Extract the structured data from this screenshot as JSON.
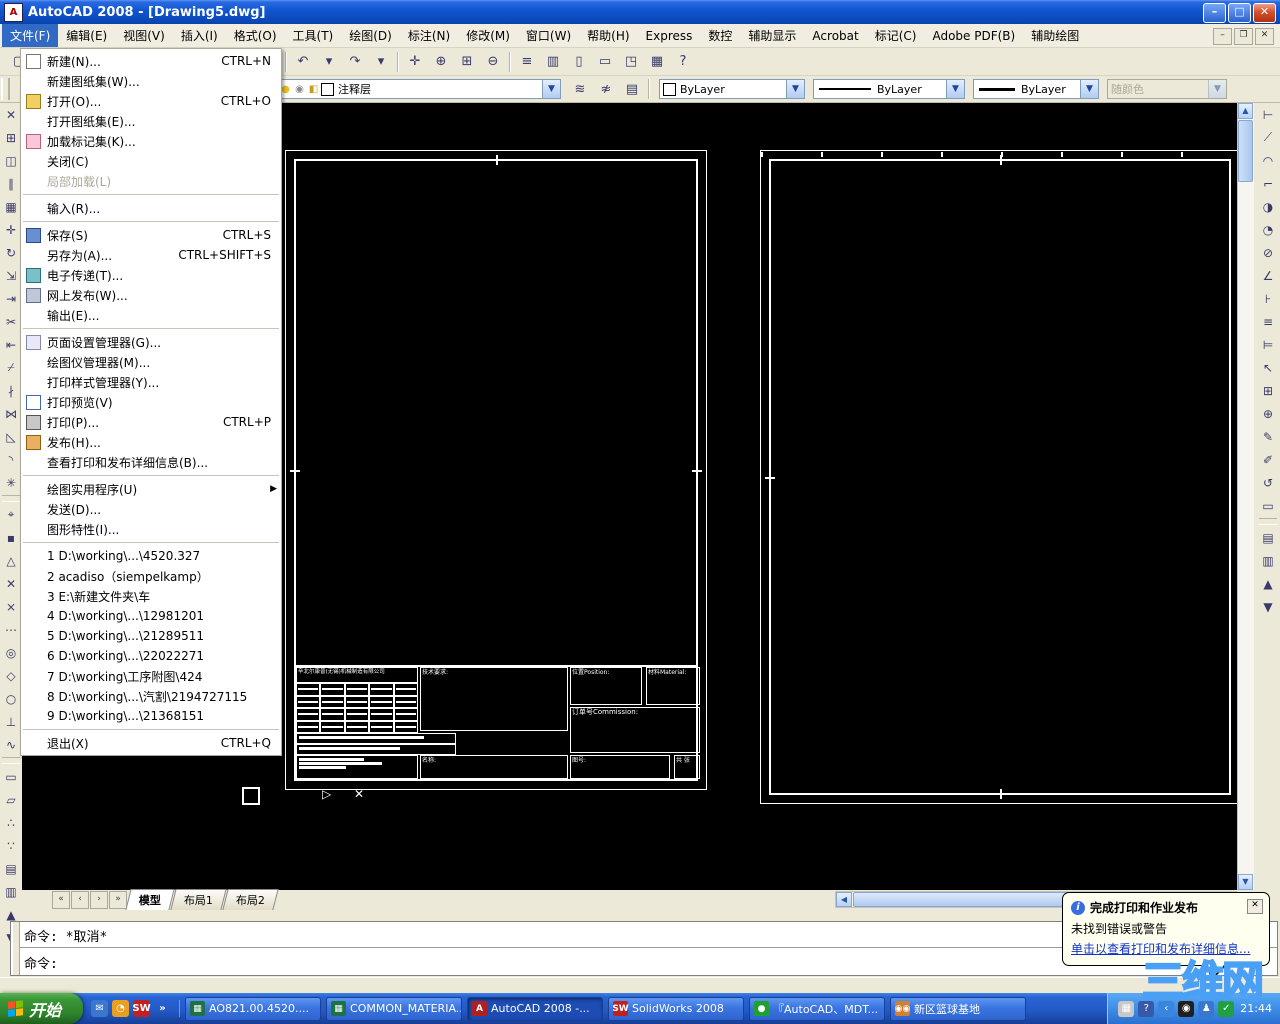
{
  "titlebar": {
    "title": "AutoCAD 2008 - [Drawing5.dwg]",
    "buttons": {
      "minimize": "–",
      "maximize": "□",
      "close": "✕"
    }
  },
  "menubar": {
    "items": [
      {
        "name": "file",
        "label": "文件(F)",
        "active": true
      },
      {
        "name": "edit",
        "label": "编辑(E)"
      },
      {
        "name": "view",
        "label": "视图(V)"
      },
      {
        "name": "insert",
        "label": "插入(I)"
      },
      {
        "name": "format",
        "label": "格式(O)"
      },
      {
        "name": "tools",
        "label": "工具(T)"
      },
      {
        "name": "draw",
        "label": "绘图(D)"
      },
      {
        "name": "dimension",
        "label": "标注(N)"
      },
      {
        "name": "modify",
        "label": "修改(M)"
      },
      {
        "name": "window",
        "label": "窗口(W)"
      },
      {
        "name": "help",
        "label": "帮助(H)"
      },
      {
        "name": "express",
        "label": "Express"
      },
      {
        "name": "cnc",
        "label": "数控"
      },
      {
        "name": "aux-display",
        "label": "辅助显示"
      },
      {
        "name": "acrobat",
        "label": "Acrobat"
      },
      {
        "name": "markup",
        "label": "标记(C)"
      },
      {
        "name": "adobe-pdf",
        "label": "Adobe PDF(B)"
      },
      {
        "name": "aux-draw",
        "label": "辅助绘图"
      }
    ]
  },
  "file_menu": {
    "items": [
      {
        "type": "item",
        "name": "new",
        "icon": "new",
        "label": "新建(N)...",
        "shortcut": "CTRL+N"
      },
      {
        "type": "item",
        "name": "new-sheet-set",
        "label": "新建图纸集(W)..."
      },
      {
        "type": "item",
        "name": "open",
        "icon": "open",
        "label": "打开(O)...",
        "shortcut": "CTRL+O"
      },
      {
        "type": "item",
        "name": "open-sheet-set",
        "label": "打开图纸集(E)..."
      },
      {
        "type": "item",
        "name": "load-markup-set",
        "icon": "markup",
        "label": "加载标记集(K)..."
      },
      {
        "type": "item",
        "name": "close",
        "label": "关闭(C)"
      },
      {
        "type": "item",
        "name": "partial-load",
        "label": "局部加载(L)",
        "disabled": true
      },
      {
        "type": "sep"
      },
      {
        "type": "item",
        "name": "import",
        "label": "输入(R)..."
      },
      {
        "type": "sep"
      },
      {
        "type": "item",
        "name": "save",
        "icon": "save",
        "label": "保存(S)",
        "shortcut": "CTRL+S"
      },
      {
        "type": "item",
        "name": "save-as",
        "label": "另存为(A)...",
        "shortcut": "CTRL+SHIFT+S"
      },
      {
        "type": "item",
        "name": "etransmit",
        "icon": "etransmit",
        "label": "电子传递(T)..."
      },
      {
        "type": "item",
        "name": "publish-to-web",
        "icon": "web",
        "label": "网上发布(W)..."
      },
      {
        "type": "item",
        "name": "export",
        "label": "输出(E)..."
      },
      {
        "type": "sep"
      },
      {
        "type": "item",
        "name": "page-setup-manager",
        "icon": "pagesetup",
        "label": "页面设置管理器(G)..."
      },
      {
        "type": "item",
        "name": "plotter-manager",
        "label": "绘图仪管理器(M)..."
      },
      {
        "type": "item",
        "name": "plot-style-manager",
        "label": "打印样式管理器(Y)..."
      },
      {
        "type": "item",
        "name": "plot-preview",
        "icon": "preview",
        "label": "打印预览(V)"
      },
      {
        "type": "item",
        "name": "plot",
        "icon": "print",
        "label": "打印(P)...",
        "shortcut": "CTRL+P"
      },
      {
        "type": "item",
        "name": "publish",
        "icon": "publish",
        "label": "发布(H)..."
      },
      {
        "type": "item",
        "name": "view-plot-details",
        "label": "查看打印和发布详细信息(B)..."
      },
      {
        "type": "sep"
      },
      {
        "type": "item",
        "name": "drawing-utilities",
        "label": "绘图实用程序(U)",
        "submenu": true
      },
      {
        "type": "item",
        "name": "send",
        "label": "发送(D)..."
      },
      {
        "type": "item",
        "name": "drawing-properties",
        "label": "图形特性(I)..."
      },
      {
        "type": "sep"
      },
      {
        "type": "item",
        "name": "recent-1",
        "label": "1 D:\\working\\...\\4520.327"
      },
      {
        "type": "item",
        "name": "recent-2",
        "label": "2 acadiso（siempelkamp）"
      },
      {
        "type": "item",
        "name": "recent-3",
        "label": "3 E:\\新建文件夹\\车"
      },
      {
        "type": "item",
        "name": "recent-4",
        "label": "4 D:\\working\\...\\12981201"
      },
      {
        "type": "item",
        "name": "recent-5",
        "label": "5 D:\\working\\...\\21289511"
      },
      {
        "type": "item",
        "name": "recent-6",
        "label": "6 D:\\working\\...\\22022271"
      },
      {
        "type": "item",
        "name": "recent-7",
        "label": "7 D:\\working\\工序附图\\424"
      },
      {
        "type": "item",
        "name": "recent-8",
        "label": "8 D:\\working\\...\\汽割\\2194727115"
      },
      {
        "type": "item",
        "name": "recent-9",
        "label": "9 D:\\working\\...\\21368151"
      },
      {
        "type": "sep"
      },
      {
        "type": "item",
        "name": "exit",
        "label": "退出(X)",
        "shortcut": "CTRL+Q"
      }
    ]
  },
  "toolbar_standard": {
    "buttons": [
      {
        "n": "qnew",
        "g": "▢"
      },
      {
        "n": "open",
        "g": "▤"
      },
      {
        "n": "save",
        "g": "▦"
      },
      {
        "sep": true
      },
      {
        "n": "plot",
        "g": "▧"
      },
      {
        "n": "plot-preview",
        "g": "▨"
      },
      {
        "n": "publish",
        "g": "▩"
      },
      {
        "sep": true
      },
      {
        "n": "cut",
        "g": "✂"
      },
      {
        "n": "copy-clip",
        "g": "⊞"
      },
      {
        "n": "paste",
        "g": "⊟"
      },
      {
        "n": "match-properties",
        "g": "✎"
      },
      {
        "sep": true
      },
      {
        "n": "undo",
        "g": "↶"
      },
      {
        "n": "undo-dropdown",
        "g": "▾"
      },
      {
        "n": "redo",
        "g": "↷"
      },
      {
        "n": "redo-dropdown",
        "g": "▾"
      },
      {
        "sep": true
      },
      {
        "n": "pan",
        "g": "✛"
      },
      {
        "n": "zoom-realtime",
        "g": "⊕"
      },
      {
        "n": "zoom-window",
        "g": "⊞"
      },
      {
        "n": "zoom-previous",
        "g": "⊖"
      },
      {
        "sep": true
      },
      {
        "n": "properties-palette",
        "g": "≡"
      },
      {
        "n": "designcenter",
        "g": "▥"
      },
      {
        "n": "tool-palettes",
        "g": "▯"
      },
      {
        "n": "sheet-set-manager",
        "g": "▭"
      },
      {
        "n": "markup-set-manager",
        "g": "◳"
      },
      {
        "n": "quickcalc",
        "g": "▦"
      },
      {
        "n": "help",
        "g": "?"
      }
    ]
  },
  "layers_toolbar": {
    "combo_icons": [
      {
        "n": "layer-on-bulb",
        "g": "○",
        "c": "#e8c020"
      },
      {
        "n": "layer-freeze-sun",
        "g": "●",
        "c": "#e8c020"
      },
      {
        "n": "layer-plot",
        "g": "◉",
        "c": "#888888"
      },
      {
        "n": "layer-lock",
        "g": "◧",
        "c": "#c8a020"
      }
    ],
    "layer_value": "注释层",
    "buttons": [
      {
        "n": "make-object-layer-current",
        "g": "≋"
      },
      {
        "n": "layer-previous",
        "g": "≉"
      },
      {
        "n": "layer-properties-manager",
        "g": "▤"
      }
    ]
  },
  "properties_toolbar": {
    "color_value": "ByLayer",
    "linetype_value": "ByLayer",
    "lineweight_value": "ByLayer",
    "plotstyle_value": "随颜色",
    "plotstyle_disabled": true
  },
  "left_toolbar": {
    "buttons": [
      {
        "n": "erase",
        "g": "✕"
      },
      {
        "n": "copy",
        "g": "⊞"
      },
      {
        "n": "mirror",
        "g": "◫"
      },
      {
        "n": "offset",
        "g": "∥"
      },
      {
        "n": "array",
        "g": "▦"
      },
      {
        "n": "move",
        "g": "✛"
      },
      {
        "n": "rotate",
        "g": "↻"
      },
      {
        "n": "scale",
        "g": "⇲"
      },
      {
        "n": "stretch",
        "g": "⇥"
      },
      {
        "n": "trim",
        "g": "✂"
      },
      {
        "n": "extend",
        "g": "⇤"
      },
      {
        "n": "break-at-point",
        "g": "⌿"
      },
      {
        "n": "break",
        "g": "∤"
      },
      {
        "n": "join",
        "g": "⋈"
      },
      {
        "n": "chamfer",
        "g": "◺"
      },
      {
        "n": "fillet",
        "g": "◝"
      },
      {
        "n": "explode",
        "g": "✳"
      },
      {
        "sep": true
      },
      {
        "n": "snap-from",
        "g": "⌖"
      },
      {
        "n": "snap-endpoint",
        "g": "▪"
      },
      {
        "n": "snap-midpoint",
        "g": "△"
      },
      {
        "n": "snap-intersection",
        "g": "✕"
      },
      {
        "n": "snap-apparent-intersection",
        "g": "⨯"
      },
      {
        "n": "snap-extension",
        "g": "⋯"
      },
      {
        "n": "snap-center",
        "g": "◎"
      },
      {
        "n": "snap-quadrant",
        "g": "◇"
      },
      {
        "n": "snap-tangent",
        "g": "○"
      },
      {
        "n": "snap-perpendicular",
        "g": "⊥"
      },
      {
        "n": "snap-nearest",
        "g": "∿"
      },
      {
        "sep": true
      },
      {
        "n": "region",
        "g": "▭"
      },
      {
        "n": "boundary",
        "g": "▱"
      },
      {
        "n": "divide",
        "g": "∴"
      },
      {
        "n": "measure",
        "g": "∵"
      },
      {
        "n": "draworder-front",
        "g": "▤"
      },
      {
        "n": "draworder-back",
        "g": "▥"
      },
      {
        "n": "draworder-above",
        "g": "▲"
      },
      {
        "n": "draworder-below",
        "g": "▼"
      }
    ]
  },
  "right_toolbar": {
    "buttons": [
      {
        "n": "dim-linear",
        "g": "⊢"
      },
      {
        "n": "dim-aligned",
        "g": "⟋"
      },
      {
        "n": "dim-arc-length",
        "g": "◠"
      },
      {
        "n": "dim-ordinate",
        "g": "⌐"
      },
      {
        "n": "dim-radius",
        "g": "◑"
      },
      {
        "n": "dim-jogged",
        "g": "◔"
      },
      {
        "n": "dim-diameter",
        "g": "⊘"
      },
      {
        "n": "dim-angular",
        "g": "∠"
      },
      {
        "n": "quick-dimension",
        "g": "⊦"
      },
      {
        "n": "dim-baseline",
        "g": "≡"
      },
      {
        "n": "dim-continue",
        "g": "⊨"
      },
      {
        "n": "quick-leader",
        "g": "↖"
      },
      {
        "n": "tolerance",
        "g": "⊞"
      },
      {
        "n": "center-mark",
        "g": "⊕"
      },
      {
        "n": "dim-edit",
        "g": "✎"
      },
      {
        "n": "dim-text-edit",
        "g": "✐"
      },
      {
        "n": "dim-update",
        "g": "↺"
      },
      {
        "n": "dim-style",
        "g": "▭"
      },
      {
        "sep": true
      },
      {
        "n": "bring-to-front",
        "g": "▤"
      },
      {
        "n": "send-to-back",
        "g": "▥"
      },
      {
        "n": "bring-above",
        "g": "▲"
      },
      {
        "n": "send-under",
        "g": "▼"
      }
    ]
  },
  "drawing": {
    "title_block": {
      "company": "辛北尔康普(无锡)机械制造有限公司",
      "tech_req_label": "技术要求:",
      "position_label": "位置Position:",
      "material_label": "材料Material:",
      "commission_label": "订单号Commission:",
      "name_label": "名称:",
      "drawing_no_label": "图号:",
      "sheet_label": "共 张"
    },
    "tolerance_grid": {
      "rows": 4,
      "cols": 5
    }
  },
  "layout_tabs": {
    "nav": [
      "«",
      "‹",
      "›",
      "»"
    ],
    "tabs": [
      {
        "name": "model",
        "label": "模型",
        "active": true
      },
      {
        "name": "layout1",
        "label": "布局1",
        "active": false
      },
      {
        "name": "layout2",
        "label": "布局2",
        "active": false
      }
    ]
  },
  "command_line": {
    "history": "命令: *取消*",
    "prompt": "命令:"
  },
  "balloon": {
    "title": "完成打印和作业发布",
    "message": "未找到错误或警告",
    "link": "单击以查看打印和发布详细信息...",
    "close": "✕"
  },
  "watermark": {
    "text": "三维网"
  },
  "taskbar": {
    "start_label": "开始",
    "quick_launch": [
      {
        "n": "outlook-icon",
        "g": "✉",
        "c": "#3a78d0"
      },
      {
        "n": "clock-icon",
        "g": "◔",
        "c": "#e8a020"
      },
      {
        "n": "solidworks-icon",
        "g": "SW",
        "c": "#c02020"
      },
      {
        "n": "chevron-icon",
        "g": "»",
        "c": "transparent"
      }
    ],
    "tasks": [
      {
        "name": "task-excel-1",
        "label": "AO821.00.4520....",
        "icon": "▦",
        "iconc": "#1e7145",
        "active": false
      },
      {
        "name": "task-excel-2",
        "label": "COMMON_MATERIA...",
        "icon": "▦",
        "iconc": "#1e7145",
        "active": false
      },
      {
        "name": "task-autocad",
        "label": "AutoCAD 2008 -...",
        "icon": "A",
        "iconc": "#b02020",
        "active": true
      },
      {
        "name": "task-solidworks",
        "label": "SolidWorks 2008",
        "icon": "SW",
        "iconc": "#c02020",
        "active": false
      },
      {
        "name": "task-qq-chat",
        "label": "『AutoCAD、MDT...",
        "icon": "●",
        "iconc": "#20a030",
        "active": false
      },
      {
        "name": "task-qq-group",
        "label": "新区篮球基地",
        "icon": "◉◉",
        "iconc": "#d08030",
        "active": false
      }
    ],
    "tray": {
      "icons": [
        {
          "n": "keyboard-icon",
          "g": "▦",
          "c": "#c8c8c8"
        },
        {
          "n": "ime-help-icon",
          "g": "?",
          "c": "#3858a8"
        },
        {
          "n": "collapse-chevron-icon",
          "g": "‹",
          "c": "#3a85e0"
        },
        {
          "n": "qq-icon",
          "g": "◉",
          "c": "#202020"
        },
        {
          "n": "messenger-icon",
          "g": "♟",
          "c": "#3a78d0"
        },
        {
          "n": "shield-icon",
          "g": "✓",
          "c": "#20a040"
        }
      ],
      "time": "21:44"
    }
  }
}
